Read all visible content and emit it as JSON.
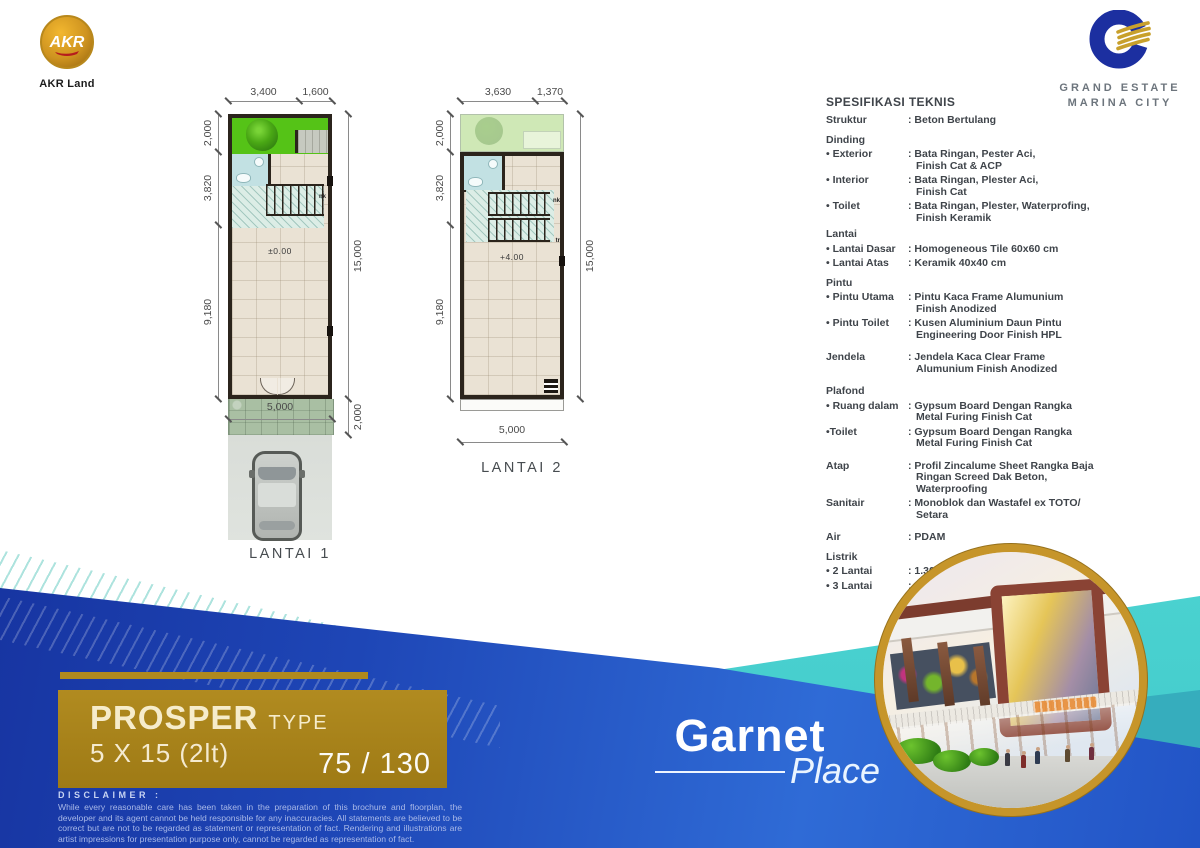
{
  "header": {
    "akr_logo_text": "AKR",
    "akr_logo_sub": "AKR Land",
    "gemc_line1": "GRAND ESTATE",
    "gemc_line2": "MARINA CITY"
  },
  "plans": {
    "p1": {
      "label": "LANTAI 1",
      "dim_top_left": "3,400",
      "dim_top_right": "1,600",
      "dim_left_1": "2,000",
      "dim_left_2": "3,820",
      "dim_left_3": "9,180",
      "dim_right": "15,000",
      "dim_right_bottom": "2,000",
      "dim_bottom": "5,000",
      "level": "±0.00",
      "stair_up": "nk"
    },
    "p2": {
      "label": "LANTAI 2",
      "dim_top_left": "3,630",
      "dim_top_right": "1,370",
      "dim_left_1": "2,000",
      "dim_left_2": "3,820",
      "dim_left_3": "9,180",
      "dim_right": "15,000",
      "dim_bottom": "5,000",
      "level": "+4.00",
      "stair_up": "nk",
      "stair_down": "tr"
    }
  },
  "specs": {
    "title": "SPESIFIKASI TEKNIS",
    "rows": [
      {
        "cls": "",
        "label": "Struktur",
        "value": ": Beton Bertulang"
      },
      {
        "cls": "g1",
        "label": "Dinding",
        "value": ""
      },
      {
        "cls": "",
        "label": "• Exterior",
        "value": ": Bata Ringan, Pester Aci,\nFinish Cat & ACP"
      },
      {
        "cls": "",
        "label": "• Interior",
        "value": ": Bata Ringan, Plester Aci,\nFinish Cat"
      },
      {
        "cls": "",
        "label": "• Toilet",
        "value": ": Bata Ringan, Plester, Waterprofing,\nFinish Keramik"
      },
      {
        "cls": "g0",
        "label": "Lantai",
        "value": ""
      },
      {
        "cls": "",
        "label": "• Lantai Dasar",
        "value": ": Homogeneous Tile 60x60 cm"
      },
      {
        "cls": "",
        "label": "• Lantai Atas",
        "value": ": Keramik 40x40 cm"
      },
      {
        "cls": "g1",
        "label": "Pintu",
        "value": ""
      },
      {
        "cls": "",
        "label": "• Pintu Utama",
        "value": ": Pintu Kaca Frame Alumunium\nFinish Anodized"
      },
      {
        "cls": "",
        "label": "• Pintu Toilet",
        "value": ": Kusen Aluminium Daun Pintu\nEngineering Door Finish HPL"
      },
      {
        "cls": "g2",
        "label": "Jendela",
        "value": ": Jendela Kaca Clear Frame\nAlumunium Finish Anodized"
      },
      {
        "cls": "g2",
        "label": "Plafond",
        "value": ""
      },
      {
        "cls": "",
        "label": "• Ruang dalam",
        "value": ":  Gypsum Board Dengan Rangka\nMetal Furing Finish Cat"
      },
      {
        "cls": "",
        "label": "•Toilet",
        "value": ": Gypsum Board Dengan Rangka\nMetal Furing Finish Cat"
      },
      {
        "cls": "g2",
        "label": "Atap",
        "value": ": Profil Zincalume Sheet Rangka Baja\nRingan Screed Dak Beton,\nWaterproofing"
      },
      {
        "cls": "",
        "label": "Sanitair",
        "value": ": Monoblok dan Wastafel ex TOTO/\nSetara"
      },
      {
        "cls": "g2",
        "label": "Air",
        "value": ": PDAM"
      },
      {
        "cls": "g1",
        "label": "Listrik",
        "value": ""
      },
      {
        "cls": "",
        "label": "• 2 Lantai",
        "value": ": 1.300 VA"
      },
      {
        "cls": "",
        "label": "• 3 Lantai",
        "value": ": 2.200 VA"
      }
    ]
  },
  "footer": {
    "type_title": "PROSPER",
    "type_suffix": "TYPE",
    "type_size": "5 X 15 (2lt)",
    "type_area": "75 / 130",
    "project_name": "Garnet",
    "project_sub": "Place",
    "disclaimer_title": "DISCLAIMER :",
    "disclaimer_body": "While every reasonable care has been taken in the preparation of this brochure and floorplan, the developer and its agent cannot be held responsible for any inaccuracies. All statements are believed to be correct but are not to be regarded as statement or representation of fact. Rendering and illustrations are artist impressions for presentation purpose only, cannot be regarded as representation of fact."
  },
  "colors": {
    "accent_gold": "#ab831c",
    "deep_blue": "#1c3aac",
    "bright_blue": "#2f6bd6",
    "aqua": "#55e0d4",
    "teal": "#36adbd",
    "garden_green": "#55c317",
    "roof_garden_green": "#cfe8b6",
    "floor_beige": "#eae2d4",
    "wall_dark": "#2b241c"
  }
}
